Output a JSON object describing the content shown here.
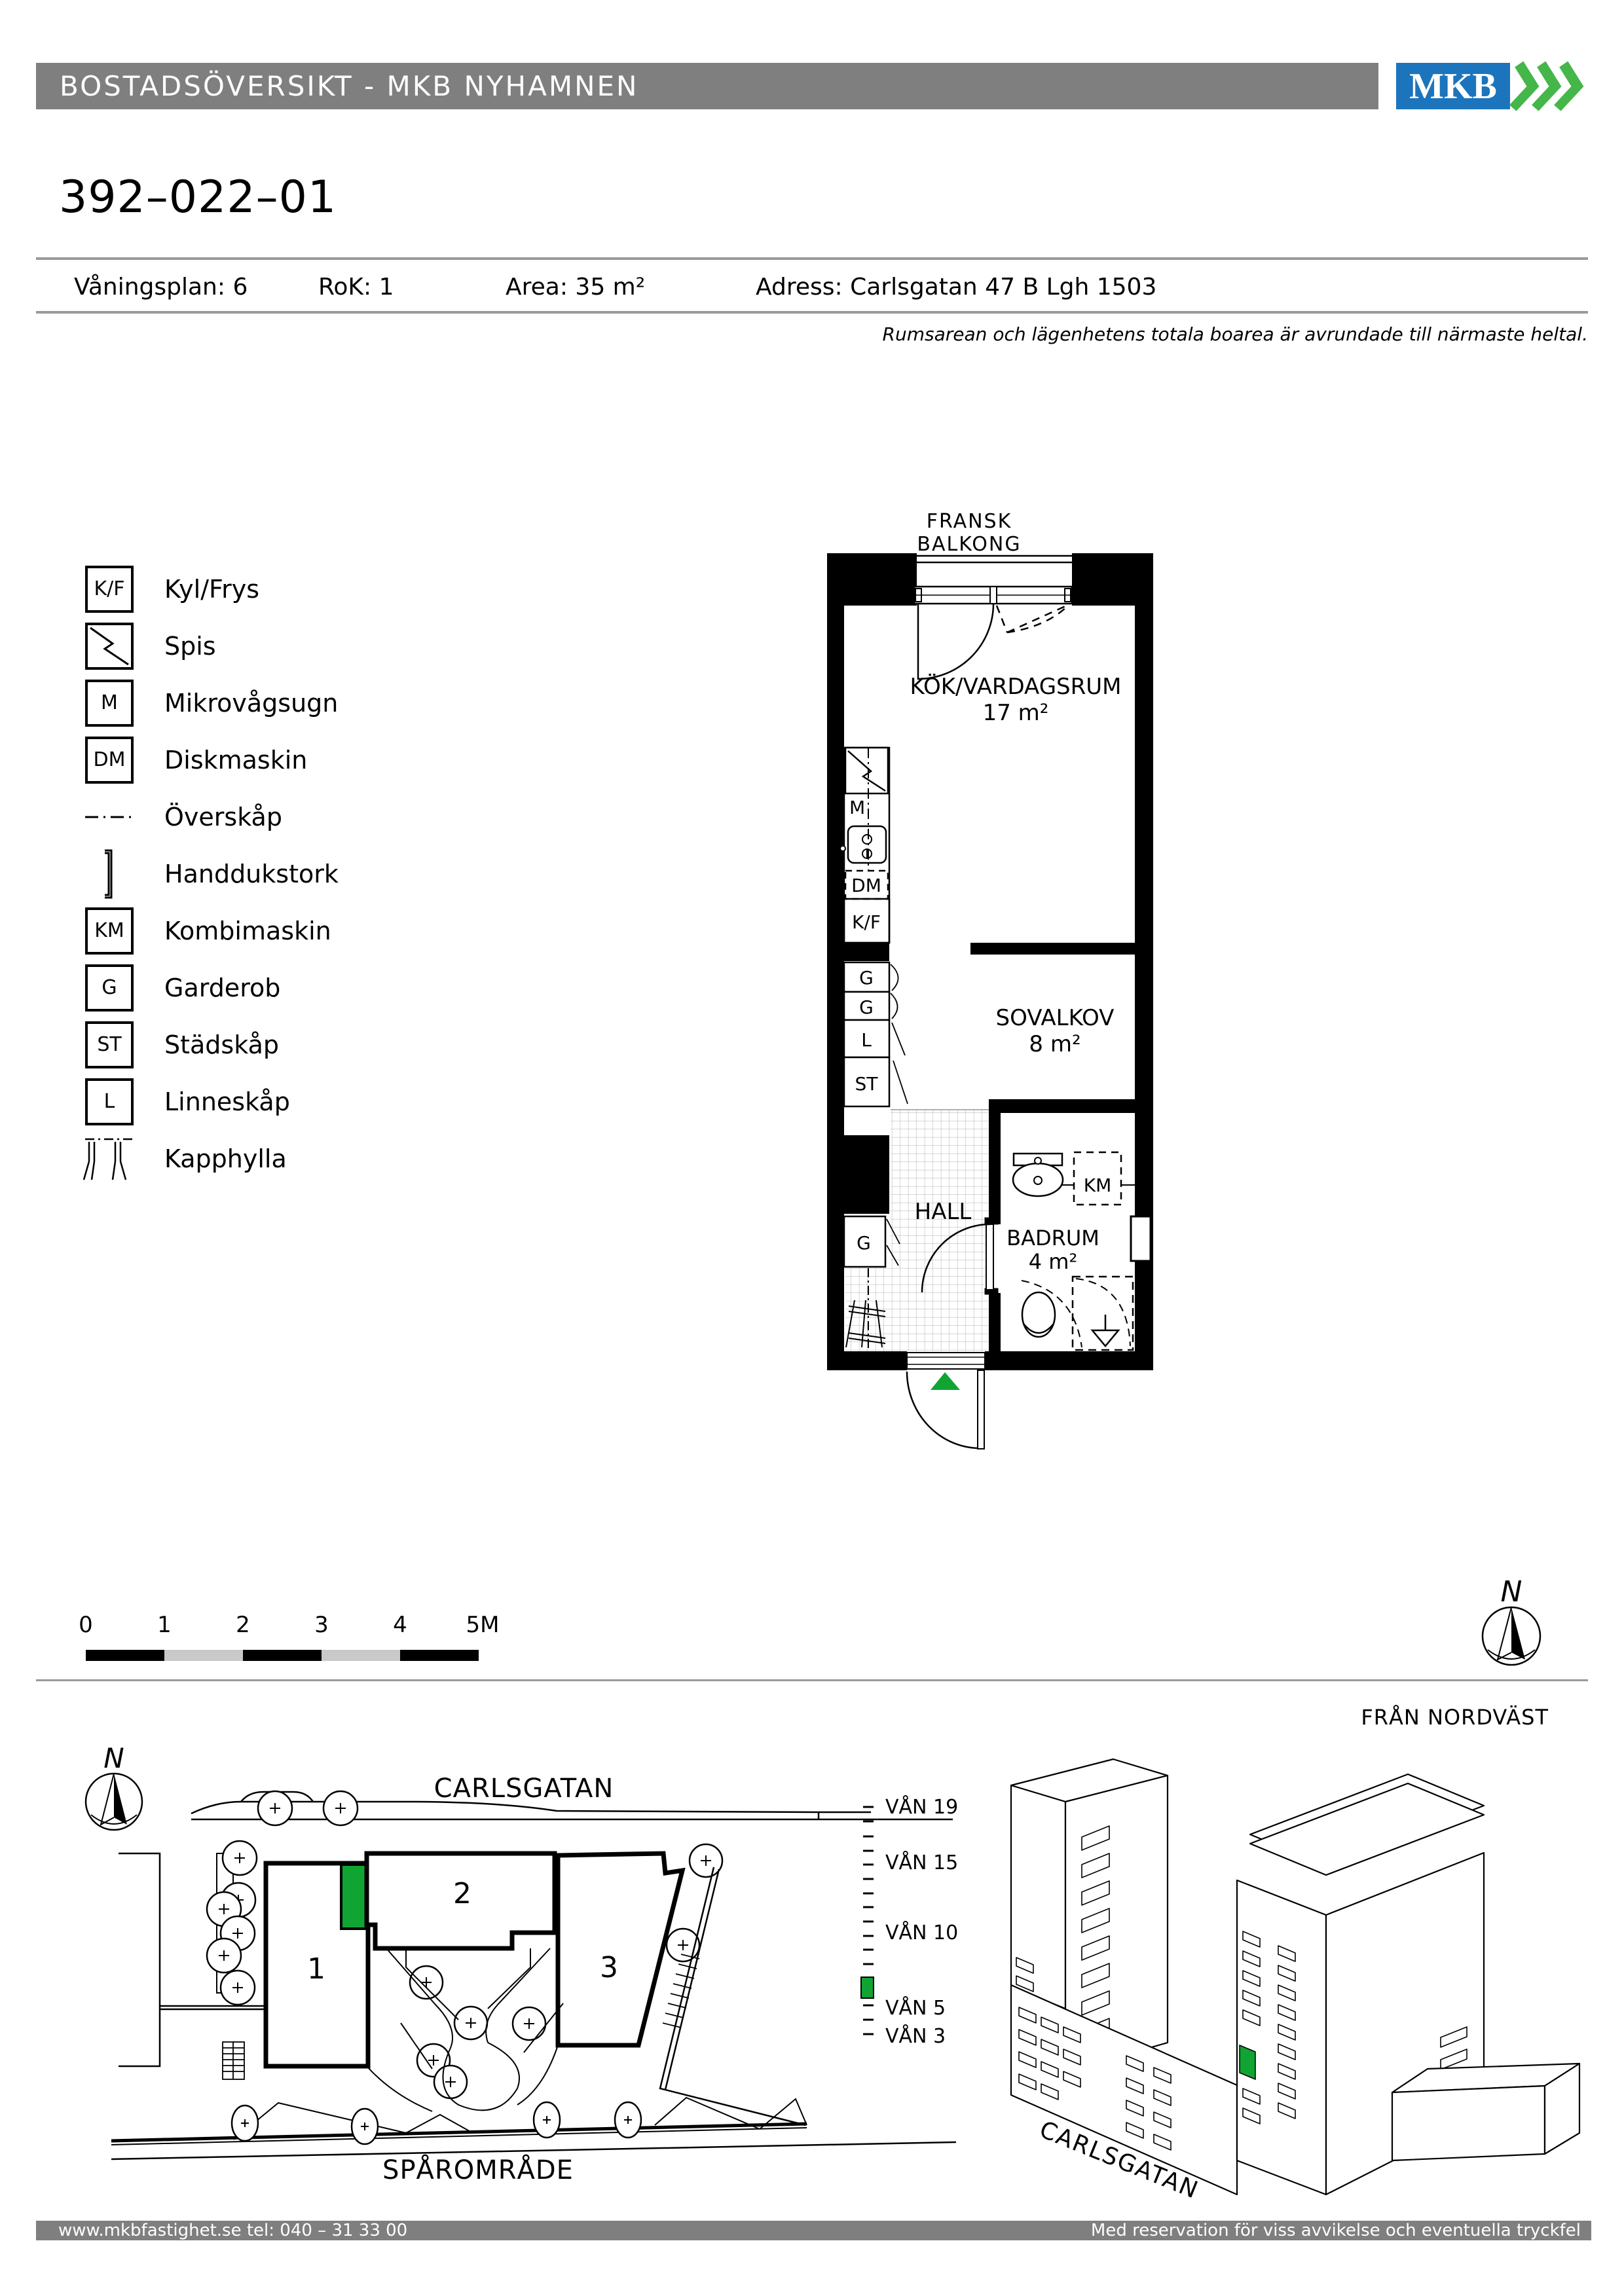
{
  "header": {
    "title": "BOSTADSÖVERSIKT - MKB NYHAMNEN",
    "logo_text": "MKB"
  },
  "apartment": {
    "id": "392–022–01",
    "floor": "Våningsplan: 6",
    "rok": "RoK: 1",
    "area": "Area:  35 m²",
    "address": "Adress: Carlsgatan 47 B Lgh 1503",
    "note": "Rumsarean och lägenhetens totala boarea är avrundade till närmaste heltal."
  },
  "legend": {
    "items": [
      {
        "symbol": "K/F",
        "icon": "fridge-freezer-box",
        "label": "Kyl/Frys"
      },
      {
        "symbol": "",
        "icon": "stove-zigzag-box",
        "label": "Spis"
      },
      {
        "symbol": "M",
        "icon": "microwave-box",
        "label": "Mikrovågsugn"
      },
      {
        "symbol": "DM",
        "icon": "dishwasher-box",
        "label": "Diskmaskin"
      },
      {
        "symbol": "",
        "icon": "dash-dot-line",
        "label": "Överskåp"
      },
      {
        "symbol": "",
        "icon": "towel-rail-bracket",
        "label": "Handdukstork"
      },
      {
        "symbol": "KM",
        "icon": "combi-machine-box",
        "label": "Kombimaskin"
      },
      {
        "symbol": "G",
        "icon": "wardrobe-box",
        "label": "Garderob"
      },
      {
        "symbol": "ST",
        "icon": "cleaning-cabinet-box",
        "label": "Städskåp"
      },
      {
        "symbol": "L",
        "icon": "linen-cabinet-box",
        "label": "Linneskåp"
      },
      {
        "symbol": "",
        "icon": "coat-rack-hatch",
        "label": "Kapphylla"
      }
    ]
  },
  "floor_plan": {
    "balcony_top": "FRANSK",
    "balcony_bottom": "BALKONG",
    "kitchen": {
      "name": "KÖK/VARDAGSRUM",
      "area": "17 m²"
    },
    "alcove": {
      "name": "SOVALKOV",
      "area": "8 m²"
    },
    "hall": {
      "name": "HALL"
    },
    "bathroom": {
      "name": "BADRUM",
      "area": "4 m²"
    },
    "fixtures": {
      "microwave": "M",
      "dishwasher": "DM",
      "fridge_freezer": "K/F",
      "wardrobe": "G",
      "linen": "L",
      "cleaning": "ST",
      "washer": "KM"
    }
  },
  "scale_bar": {
    "labels": [
      "0",
      "1",
      "2",
      "3",
      "4",
      "5M"
    ]
  },
  "site_plan": {
    "north_label": "N",
    "street": "CARLSGATAN",
    "railway": "SPÅROMRÅDE",
    "buildings": [
      "1",
      "2",
      "3"
    ]
  },
  "elevation": {
    "view_label": "FRÅN NORDVÄST",
    "street": "CARLSGATAN",
    "floors": [
      "VÅN 19",
      "VÅN 15",
      "VÅN 10",
      "VÅN 5",
      "VÅN 3"
    ]
  },
  "footer": {
    "left": "www.mkbfastighet.se   tel: 040 – 31 33 00",
    "right": "Med reservation för viss avvikelse och eventuella tryckfel"
  },
  "colors": {
    "brand_blue": "#1C75BC",
    "brand_green": "#45B649",
    "marker_green": "#10A433",
    "bar_gray": "#7f7f7f"
  }
}
